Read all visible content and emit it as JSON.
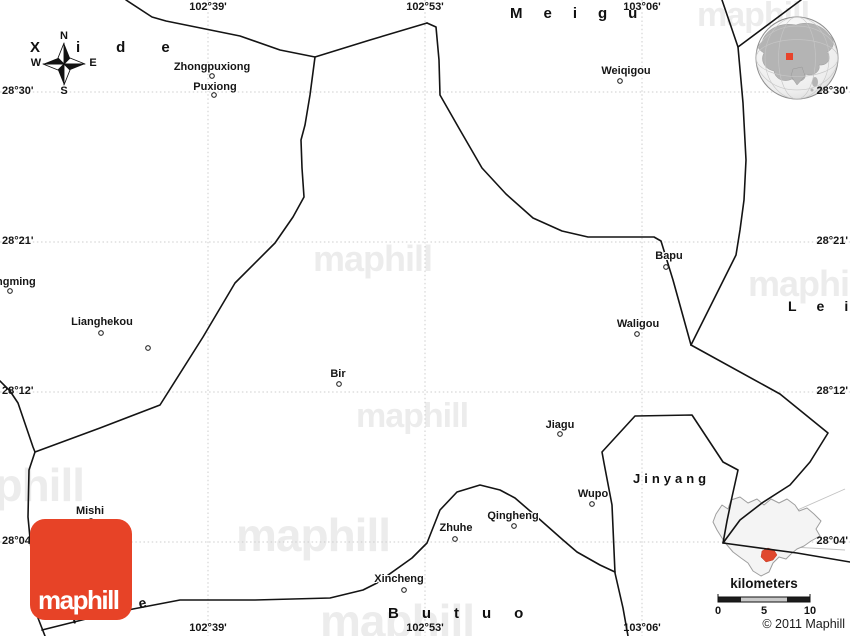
{
  "canvas": {
    "w": 850,
    "h": 636,
    "bg": "#ffffff"
  },
  "colors": {
    "border": "#141414",
    "grid": "#cdcdcd",
    "watermark": "#ececec",
    "label": "#161616",
    "logo_red": "#e74327",
    "marker_fill": "#ffffff",
    "marker_stroke": "#2a2a2a",
    "inset_fill": "#f4f4f4",
    "inset_stroke": "#9e9e9e",
    "inset_red": "#e0482e",
    "leader": "#c2c2c2",
    "globe_land": "#b4b4b4",
    "globe_stroke": "#8f8f8f",
    "globe_red": "#e8432b"
  },
  "watermark_text": "maphill",
  "watermarks": [
    {
      "left": 313,
      "top": 241,
      "fs": 36
    },
    {
      "left": 697,
      "top": -2,
      "fs": 34
    },
    {
      "left": 748,
      "top": 266,
      "fs": 36
    },
    {
      "left": 356,
      "top": 399,
      "fs": 34
    },
    {
      "left": -70,
      "top": 462,
      "fs": 46
    },
    {
      "left": 236,
      "top": 512,
      "fs": 46
    },
    {
      "left": 320,
      "top": 598,
      "fs": 46
    }
  ],
  "grid": {
    "rows": [
      {
        "y": 92,
        "left": "28°30'",
        "right": "28°30'"
      },
      {
        "y": 242,
        "left": "28°21'",
        "right": "28°21'"
      },
      {
        "y": 392,
        "left": "28°12'",
        "right": "28°12'"
      },
      {
        "y": 542,
        "left": "28°04'",
        "right": "28°04'"
      }
    ],
    "cols": [
      {
        "x": 208,
        "top": "102°39'",
        "bottom": "102°39'"
      },
      {
        "x": 425,
        "top": "102°53'",
        "bottom": "102°53'"
      },
      {
        "x": 642,
        "top": "103°06'",
        "bottom": "103°06'"
      }
    ]
  },
  "borders": [
    "126,0 152,17 166,21 240,36 280,50 315,57 370,40 427,23",
    "427,23 436,27 439,60 440,95 460,130 482,168 506,194 533,218 562,231 588,237 654,237 661,241 673,280 691,345",
    "722,0 738,47 801,0",
    "738,47 743,103 746,160 744,200 740,230 736,255 691,345",
    "691,345 780,394 828,433 810,462 790,485 762,503 740,520 723,543 797,553 850,562",
    "628,636 623,608 615,573 612,505 604,463 602,452 635,416 692,415 723,462 738,470 732,497 727,521 723,543",
    "315,57 310,95 305,125 301,140 302,168 304,197 293,217 275,243 235,283 203,337 160,405 100,428 35,452",
    "0,381 10,391 18,403 33,447 35,452 29,470 28,517 33,570 38,618 45,636",
    "42,630 90,618 133,609 180,600 255,600 330,598 363,590 377,583 412,558 427,543 440,510 457,492 480,485 500,490 515,498 537,517 563,540 577,552 600,565 615,572"
  ],
  "places": [
    {
      "name": "Zhongpuxiong",
      "lx": 212,
      "ly": 61,
      "mx": 212,
      "my": 76
    },
    {
      "name": "Puxiong",
      "lx": 215,
      "ly": 81,
      "mx": 214,
      "my": 95
    },
    {
      "name": "Weiqigou",
      "lx": 626,
      "ly": 65,
      "mx": 620,
      "my": 81
    },
    {
      "name": "ngming",
      "lx": -4,
      "ly": 276,
      "mx": 10,
      "my": 291,
      "cut": true
    },
    {
      "name": "Lianghekou",
      "lx": 102,
      "ly": 316,
      "mx": 101,
      "my": 333
    },
    {
      "name": "Bir",
      "lx": 338,
      "ly": 368,
      "mx": 339,
      "my": 384
    },
    {
      "name": "Bapu",
      "lx": 669,
      "ly": 250,
      "mx": 666,
      "my": 267
    },
    {
      "name": "Waligou",
      "lx": 638,
      "ly": 318,
      "mx": 637,
      "my": 334
    },
    {
      "name": "Jiagu",
      "lx": 560,
      "ly": 419,
      "mx": 560,
      "my": 434
    },
    {
      "name": "Wupo",
      "lx": 593,
      "ly": 488,
      "mx": 592,
      "my": 504
    },
    {
      "name": "Qingheng",
      "lx": 513,
      "ly": 510,
      "mx": 514,
      "my": 526
    },
    {
      "name": "Zhuhe",
      "lx": 456,
      "ly": 522,
      "mx": 455,
      "my": 539
    },
    {
      "name": "Xincheng",
      "lx": 399,
      "ly": 573,
      "mx": 404,
      "my": 590
    },
    {
      "name": "Mishi",
      "lx": 90,
      "ly": 505,
      "mx": 91,
      "my": 521
    }
  ],
  "unlabeled_markers": [
    {
      "x": 148,
      "y": 348
    }
  ],
  "regions": [
    {
      "name": "Xide",
      "left": 30,
      "top": 40,
      "fs": 15,
      "ls": 36
    },
    {
      "name": "Meigu",
      "left": 510,
      "top": 6,
      "fs": 15,
      "ls": 21
    },
    {
      "name": "Lei",
      "left": 788,
      "top": 299,
      "fs": 14,
      "ls": 20
    },
    {
      "name": "Jinyang",
      "left": 633,
      "top": 472,
      "fs": 13,
      "ls": 4
    },
    {
      "name": "Butuo",
      "left": 388,
      "top": 606,
      "fs": 15,
      "ls": 23
    },
    {
      "name": "Puge",
      "left": 72,
      "top": 612,
      "fs": 14,
      "ls": 14,
      "rot": -13
    }
  ],
  "compass": {
    "cx": 64,
    "cy": 64,
    "n": "N",
    "e": "E",
    "s": "S",
    "w": "W"
  },
  "globe": {
    "cx": 797,
    "cy": 58,
    "r": 41
  },
  "inset": {
    "outline": "716,514 722,505 728,509 731,500 740,497 748,503 757,499 764,505 771,499 779,503 787,499 795,505 799,511 807,508 814,514 821,521 816,529 820,536 811,541 804,546 797,549 791,554 786,559 779,557 773,563 769,572 761,576 753,571 748,563 741,558 733,552 727,545 722,538 717,530 713,522",
    "red_area": "762,551 768,548 774,550 777,555 773,560 766,562 761,557",
    "leaders": [
      [
        723,
        543,
        845,
        489
      ],
      [
        723,
        543,
        845,
        550
      ]
    ]
  },
  "scalebar": {
    "title": "kilometers",
    "x": 718,
    "y": 597,
    "w": 92,
    "h": 5,
    "seg_colors": [
      "#1c1c1c",
      "#c9c9c9",
      "#c9c9c9",
      "#1c1c1c"
    ],
    "ticks": [
      {
        "label": "0",
        "x": 718
      },
      {
        "label": "5",
        "x": 764
      },
      {
        "label": "10",
        "x": 810
      }
    ]
  },
  "logo": {
    "text": "maphill"
  },
  "copyright": "© 2011 Maphill"
}
